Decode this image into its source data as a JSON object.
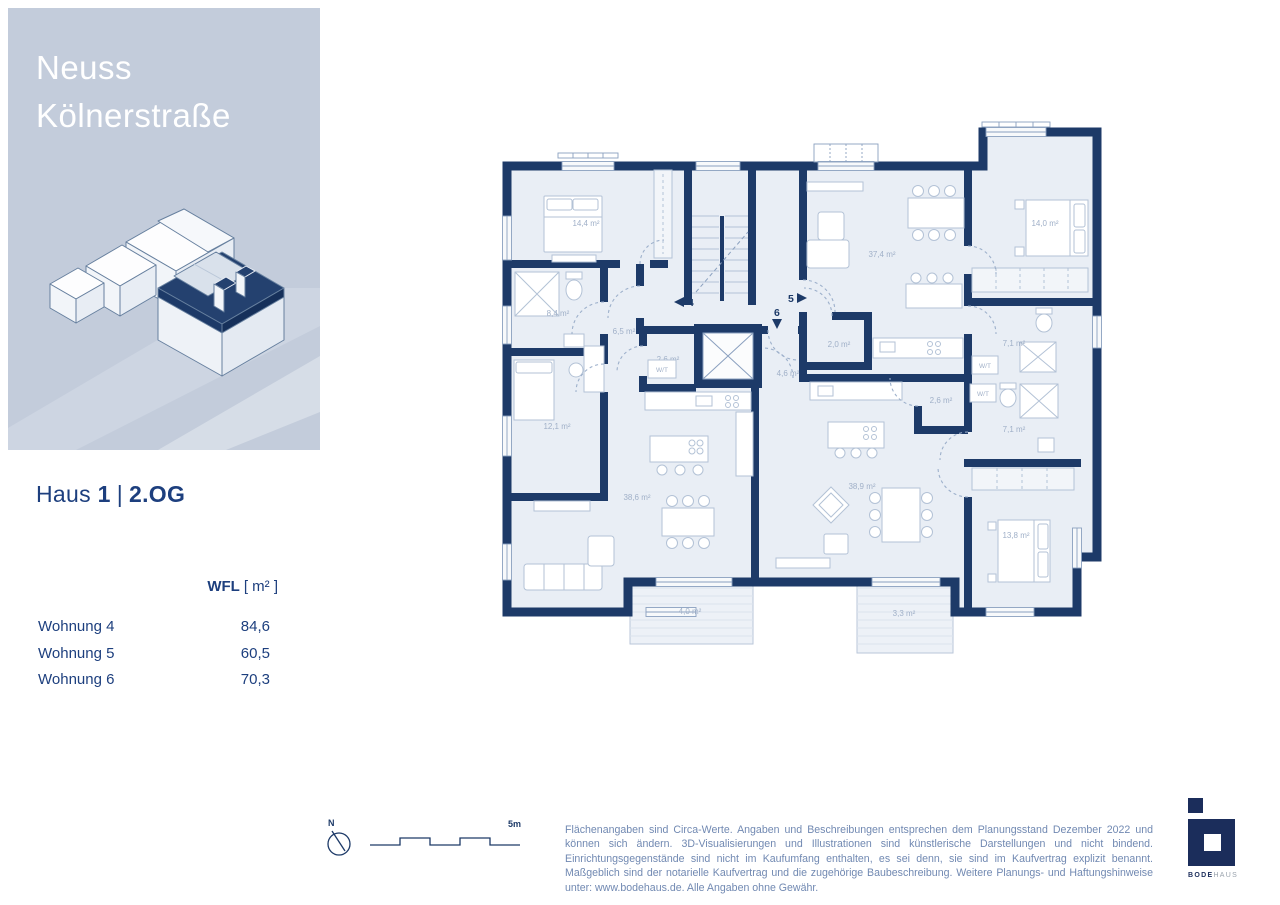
{
  "sidebar": {
    "title_line1": "Neuss",
    "title_line2": "Kölnerstraße"
  },
  "heading": {
    "haus": "Haus",
    "number": "1",
    "separator": "|",
    "floor": "2.OG"
  },
  "table": {
    "header_bold": "WFL",
    "header_unit": "[ m² ]",
    "rows": [
      {
        "label": "Wohnung 4",
        "value": "84,6"
      },
      {
        "label": "Wohnung 5",
        "value": "60,5"
      },
      {
        "label": "Wohnung 6",
        "value": "70,3"
      }
    ]
  },
  "plan": {
    "rooms": [
      {
        "name": "schlafzimmer-apt4",
        "label": "14,4 m²"
      },
      {
        "name": "bad-apt4",
        "label": "8,4 m²"
      },
      {
        "name": "flur-apt4",
        "label": "6,5 m²"
      },
      {
        "name": "abstellraum-apt4",
        "label": "2,6 m²"
      },
      {
        "name": "flur-apt6",
        "label": "4,6 m²"
      },
      {
        "name": "wohnen-apt5",
        "label": "37,4 m²"
      },
      {
        "name": "abstellraum-apt5",
        "label": "2,0 m²"
      },
      {
        "name": "schlafzimmer-apt5",
        "label": "14,0 m²"
      },
      {
        "name": "bad-apt5",
        "label": "7,1 m²"
      },
      {
        "name": "zimmer-apt4",
        "label": "12,1 m²"
      },
      {
        "name": "wohnen-apt4",
        "label": "38,6 m²"
      },
      {
        "name": "balkon-apt4",
        "label": "4,0 m²"
      },
      {
        "name": "wohnen-apt6",
        "label": "38,9 m²"
      },
      {
        "name": "abstellraum-apt6",
        "label": "2,6 m²"
      },
      {
        "name": "bad-apt6",
        "label": "7,1 m²"
      },
      {
        "name": "schlafzimmer-apt6",
        "label": "13,8 m²"
      },
      {
        "name": "balkon-apt6",
        "label": "3,3 m²"
      }
    ],
    "wt_labels": [
      "W/T",
      "W/T",
      "W/T"
    ],
    "markers": {
      "apt4": "4",
      "apt5": "5",
      "apt6": "6"
    }
  },
  "footer": {
    "compass_label": "N",
    "scale_label": "5m",
    "disclaimer": "Flächenangaben sind Circa-Werte. Angaben und Beschreibungen entsprechen dem Planungsstand Dezember 2022 und können sich ändern. 3D-Visualisierungen und Illustrationen sind künstlerische Darstellungen und nicht bindend. Einrichtungsgegenstände sind nicht im Kaufumfang enthalten, es sei denn, sie sind im Kaufvertrag explizit benannt. Maßgeblich sind der notarielle Kaufvertrag und die zugehörige Baubeschreibung. Weitere Planungs- und Haftungshinweise unter: www.bodehaus.de. Alle Angaben ohne Gewähr."
  },
  "logo": {
    "part_bold": "BODE",
    "part_light": "HAUS"
  },
  "colors": {
    "wall_navy": "#1d3a68",
    "panel_blue": "#c3ccdb",
    "room_fill": "#e9eef5",
    "accent_text": "#1d3f7e",
    "muted_text": "#7189b2"
  }
}
